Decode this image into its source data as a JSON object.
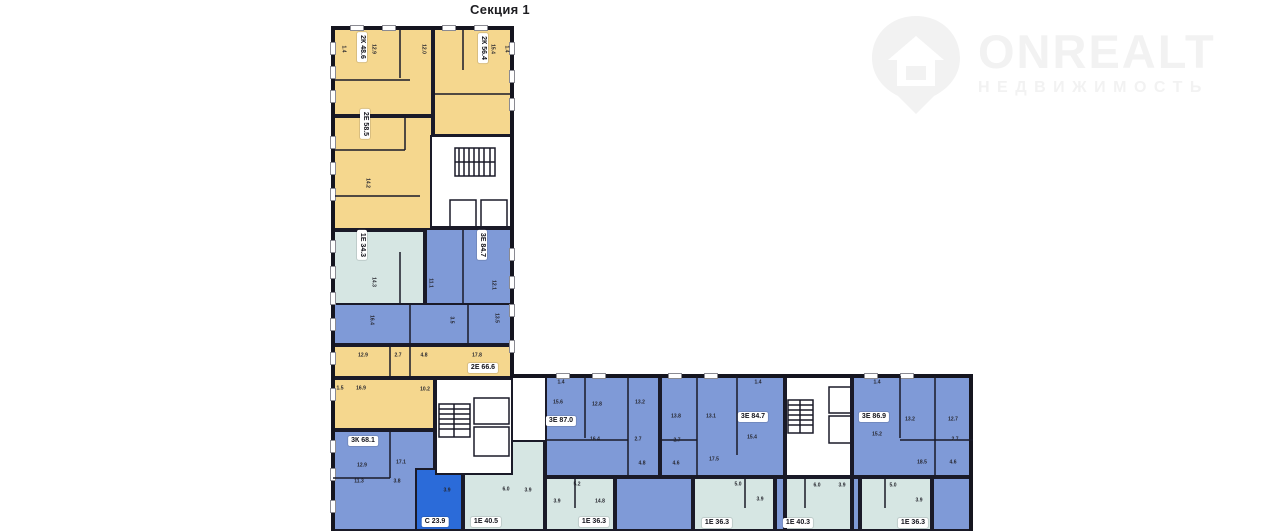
{
  "title": "Секция 1",
  "watermark": {
    "brand": "ONREALT",
    "subtitle": "НЕДВИЖИМОСТЬ"
  },
  "colors": {
    "wall": "#15151f",
    "yellow": "#f5d78e",
    "teal": "#d6e6e3",
    "blue": "#7f9ad7",
    "bright": "#2b6bd9",
    "label_text": "#14141c",
    "watermark": "#f2f2f2"
  },
  "apartments": [
    {
      "type": "2К",
      "area": "48.6",
      "color": "yellow",
      "rects": [
        [
          333,
          28,
          100,
          88
        ]
      ],
      "label": [
        362,
        47
      ],
      "rot": true
    },
    {
      "type": "2К",
      "area": "56.4",
      "color": "yellow",
      "rects": [
        [
          433,
          28,
          80,
          108
        ]
      ],
      "label": [
        483,
        48
      ],
      "rot": true
    },
    {
      "type": "2Е",
      "area": "58.5",
      "color": "yellow",
      "rects": [
        [
          333,
          116,
          100,
          114
        ]
      ],
      "label": [
        365,
        124
      ],
      "rot": true
    },
    {
      "type": "1Е",
      "area": "34.3",
      "color": "teal",
      "rects": [
        [
          333,
          230,
          92,
          80
        ]
      ],
      "label": [
        362,
        245
      ],
      "rot": true
    },
    {
      "type": "3Е",
      "area": "84.7",
      "color": "blue",
      "rects": [
        [
          425,
          228,
          88,
          77
        ],
        [
          333,
          303,
          180,
          42
        ]
      ],
      "label": [
        482,
        245
      ],
      "rot": true
    },
    {
      "type": "2Е",
      "area": "66.6",
      "color": "yellow",
      "rects": [
        [
          333,
          345,
          180,
          33
        ],
        [
          333,
          378,
          102,
          52
        ]
      ],
      "label": [
        483,
        368
      ],
      "rot": false
    },
    {
      "type": "3К",
      "area": "68.1",
      "color": "blue",
      "rects": [
        [
          333,
          430,
          102,
          101
        ]
      ],
      "label": [
        363,
        441
      ],
      "rot": false
    },
    {
      "type": "С",
      "area": "23.9",
      "color": "bright",
      "rects": [
        [
          415,
          468,
          48,
          63
        ]
      ],
      "label": [
        435,
        522
      ],
      "rot": false
    },
    {
      "type": "1Е",
      "area": "40.5",
      "color": "teal",
      "rects": [
        [
          463,
          440,
          82,
          91
        ]
      ],
      "label": [
        486,
        522
      ],
      "rot": false
    },
    {
      "type": "3Е",
      "area": "87.0",
      "color": "blue",
      "rects": [
        [
          545,
          376,
          115,
          101
        ]
      ],
      "label": [
        561,
        421
      ],
      "rot": false
    },
    {
      "type": "3Е",
      "area": "84.7",
      "color": "blue",
      "rects": [
        [
          660,
          376,
          125,
          101
        ]
      ],
      "label": [
        753,
        417
      ],
      "rot": false
    },
    {
      "type": "3Е",
      "area": "86.9",
      "color": "blue",
      "rects": [
        [
          852,
          376,
          121,
          101
        ],
        [
          932,
          477,
          41,
          54
        ]
      ],
      "label": [
        874,
        417
      ],
      "rot": false
    },
    {
      "type": "1Е",
      "area": "36.3",
      "color": "teal",
      "rects": [
        [
          545,
          477,
          70,
          54
        ]
      ],
      "label": [
        594,
        522
      ],
      "rot": false
    },
    {
      "type": "1Е",
      "area": "36.3",
      "color": "teal",
      "rects": [
        [
          693,
          477,
          82,
          54
        ]
      ],
      "label": [
        717,
        523
      ],
      "rot": false
    },
    {
      "type": "1Е",
      "area": "40.3",
      "color": "teal",
      "rects": [
        [
          785,
          477,
          67,
          54
        ]
      ],
      "label": [
        798,
        523
      ],
      "rot": false
    },
    {
      "type": "1Е",
      "area": "36.3",
      "color": "teal",
      "rects": [
        [
          860,
          477,
          72,
          54
        ]
      ],
      "label": [
        913,
        523
      ],
      "rot": false
    }
  ],
  "corridors": [
    [
      615,
      477,
      78,
      54
    ],
    [
      775,
      477,
      10,
      54
    ],
    [
      852,
      477,
      8,
      54
    ]
  ],
  "cores": [
    [
      430,
      135,
      83,
      93
    ],
    [
      435,
      378,
      78,
      97
    ],
    [
      785,
      376,
      67,
      101
    ]
  ],
  "room_numbers": [
    {
      "t": "1.4",
      "x": 343,
      "y": 49,
      "r": 1
    },
    {
      "t": "12.9",
      "x": 373,
      "y": 49,
      "r": 1
    },
    {
      "t": "12.0",
      "x": 423,
      "y": 49,
      "r": 1
    },
    {
      "t": "15.4",
      "x": 492,
      "y": 49,
      "r": 1
    },
    {
      "t": "1.4",
      "x": 506,
      "y": 49,
      "r": 1
    },
    {
      "t": "14.2",
      "x": 367,
      "y": 183,
      "r": 1
    },
    {
      "t": "14.3",
      "x": 373,
      "y": 282,
      "r": 1
    },
    {
      "t": "11.1",
      "x": 430,
      "y": 283,
      "r": 1
    },
    {
      "t": "12.1",
      "x": 493,
      "y": 285,
      "r": 1
    },
    {
      "t": "16.4",
      "x": 371,
      "y": 320,
      "r": 1
    },
    {
      "t": "3.5",
      "x": 451,
      "y": 320,
      "r": 1
    },
    {
      "t": "13.5",
      "x": 496,
      "y": 318,
      "r": 1
    },
    {
      "t": "12.9",
      "x": 363,
      "y": 356
    },
    {
      "t": "2.7",
      "x": 398,
      "y": 356
    },
    {
      "t": "4.8",
      "x": 424,
      "y": 356
    },
    {
      "t": "17.8",
      "x": 477,
      "y": 356
    },
    {
      "t": "1.5",
      "x": 340,
      "y": 389
    },
    {
      "t": "16.9",
      "x": 361,
      "y": 389
    },
    {
      "t": "10.2",
      "x": 425,
      "y": 390
    },
    {
      "t": "12.9",
      "x": 362,
      "y": 466
    },
    {
      "t": "17.1",
      "x": 401,
      "y": 463
    },
    {
      "t": "11.3",
      "x": 359,
      "y": 482
    },
    {
      "t": "3.8",
      "x": 397,
      "y": 482
    },
    {
      "t": "3.9",
      "x": 447,
      "y": 491
    },
    {
      "t": "6.0",
      "x": 506,
      "y": 490
    },
    {
      "t": "3.9",
      "x": 528,
      "y": 491
    },
    {
      "t": "1.4",
      "x": 561,
      "y": 383
    },
    {
      "t": "15.6",
      "x": 558,
      "y": 403
    },
    {
      "t": "12.8",
      "x": 597,
      "y": 405
    },
    {
      "t": "13.2",
      "x": 640,
      "y": 403
    },
    {
      "t": "16.4",
      "x": 595,
      "y": 440
    },
    {
      "t": "2.7",
      "x": 638,
      "y": 440
    },
    {
      "t": "4.8",
      "x": 642,
      "y": 464
    },
    {
      "t": "1.4",
      "x": 758,
      "y": 383
    },
    {
      "t": "13.8",
      "x": 676,
      "y": 417
    },
    {
      "t": "13.1",
      "x": 711,
      "y": 417
    },
    {
      "t": "2.7",
      "x": 677,
      "y": 441
    },
    {
      "t": "4.6",
      "x": 676,
      "y": 464
    },
    {
      "t": "17.5",
      "x": 714,
      "y": 460
    },
    {
      "t": "15.4",
      "x": 752,
      "y": 438
    },
    {
      "t": "1.4",
      "x": 877,
      "y": 383
    },
    {
      "t": "13.2",
      "x": 910,
      "y": 420
    },
    {
      "t": "12.7",
      "x": 953,
      "y": 420
    },
    {
      "t": "15.2",
      "x": 877,
      "y": 435
    },
    {
      "t": "2.7",
      "x": 955,
      "y": 440
    },
    {
      "t": "4.6",
      "x": 953,
      "y": 463
    },
    {
      "t": "18.5",
      "x": 922,
      "y": 463
    },
    {
      "t": "5.2",
      "x": 577,
      "y": 485
    },
    {
      "t": "3.9",
      "x": 557,
      "y": 502
    },
    {
      "t": "14.8",
      "x": 600,
      "y": 502
    },
    {
      "t": "5.0",
      "x": 738,
      "y": 485
    },
    {
      "t": "3.9",
      "x": 760,
      "y": 500
    },
    {
      "t": "6.0",
      "x": 817,
      "y": 486
    },
    {
      "t": "3.9",
      "x": 842,
      "y": 486
    },
    {
      "t": "5.0",
      "x": 893,
      "y": 486
    },
    {
      "t": "3.9",
      "x": 919,
      "y": 501
    }
  ]
}
